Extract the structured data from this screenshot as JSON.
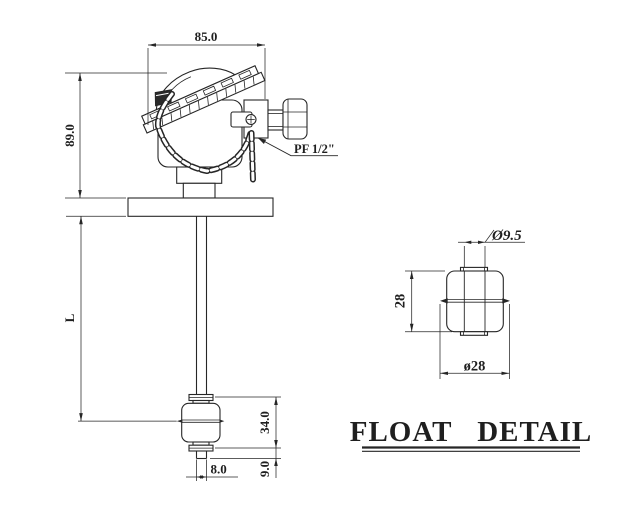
{
  "meta": {
    "background": "#ffffff",
    "line_color": "#262626"
  },
  "main_view": {
    "dim_head_width": "85.0",
    "dim_head_height": "89.0",
    "dim_stem_length": "L",
    "dim_float_height": "34.0",
    "dim_below_float": "9.0",
    "dim_plug_width": "8.0",
    "thread_label": "PF 1/2\""
  },
  "float_detail": {
    "title": "FLOAT DETAIL",
    "dim_hole_diameter": "Ø9.5",
    "dim_height": "28",
    "dim_outer_diameter": "ø28"
  }
}
